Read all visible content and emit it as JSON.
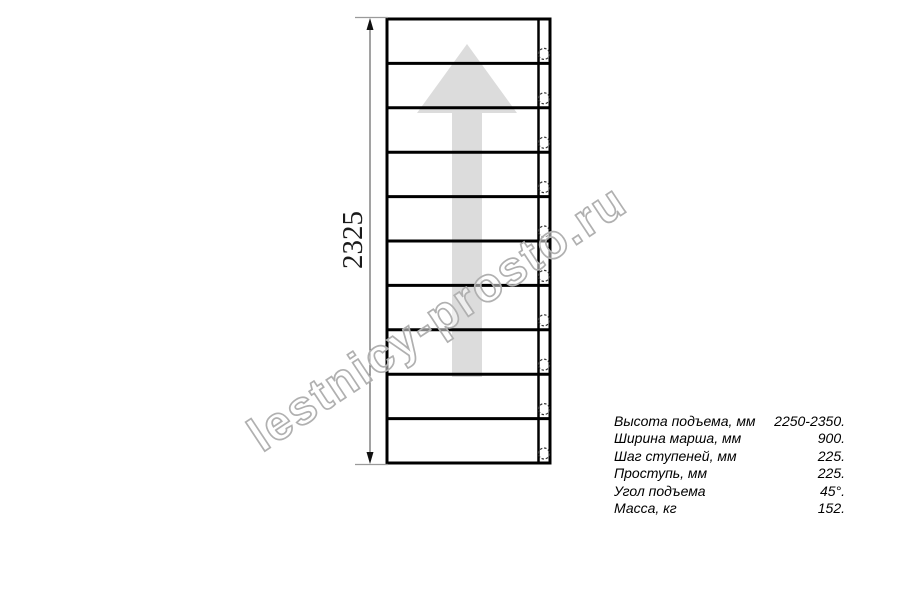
{
  "drawing": {
    "type": "staircase-top-view",
    "dimension_height_label": "2325",
    "steps": 10,
    "holes": 10,
    "arrow_direction": "up",
    "arrow_color": "#dcdcdc",
    "line_color": "#000000",
    "extension_line_color": "#9a9a9a"
  },
  "watermark": {
    "text": "lestnicy-prosto.ru",
    "stroke_color": "#b0b0b0"
  },
  "specs": {
    "rows": [
      {
        "label": "Высота подъема, мм",
        "value": "2250-2350."
      },
      {
        "label": "Ширина марша, мм",
        "value": "900."
      },
      {
        "label": "Шаг ступеней, мм",
        "value": "225."
      },
      {
        "label": "Проступь, мм",
        "value": "225."
      },
      {
        "label": "Угол подъема",
        "value": "45°."
      },
      {
        "label": "Масса, кг",
        "value": "152."
      }
    ]
  }
}
